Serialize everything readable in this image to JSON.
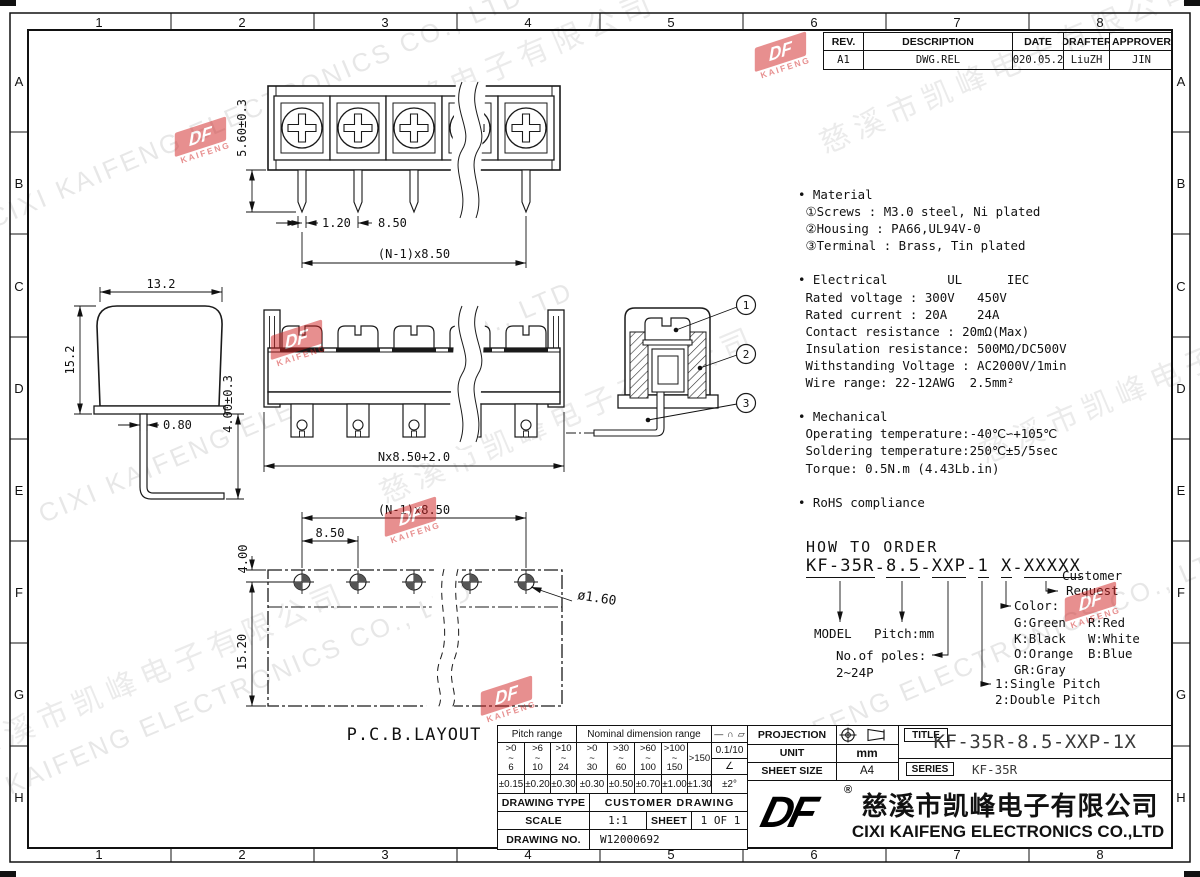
{
  "grid": {
    "cols": [
      "1",
      "2",
      "3",
      "4",
      "5",
      "6",
      "7",
      "8"
    ],
    "rows": [
      "A",
      "B",
      "C",
      "D",
      "E",
      "F",
      "G",
      "H"
    ]
  },
  "rev_table": {
    "headers": [
      "REV.",
      "DESCRIPTION",
      "DATE",
      "DRAFTER",
      "APPROVER"
    ],
    "row": [
      "A1",
      "DWG.REL",
      "2020.05.21",
      "LiuZH",
      "JIN"
    ]
  },
  "specs": {
    "lines": [
      "• Material",
      " ①Screws : M3.0 steel, Ni plated",
      " ②Housing : PA66,UL94V-0",
      " ③Terminal : Brass, Tin plated",
      "",
      "• Electrical        UL      IEC",
      " Rated voltage : 300V   450V",
      " Rated current : 20A    24A",
      " Contact resistance : 20mΩ(Max)",
      " Insulation resistance: 500MΩ/DC500V",
      " Withstanding Voltage : AC2000V/1min",
      " Wire range: 22-12AWG  2.5mm²",
      "",
      "• Mechanical",
      " Operating temperature:-40℃∽+105℃",
      " Soldering temperature:250℃±5/5sec",
      " Torque: 0.5N.m (4.43Lb.in)",
      "",
      "• RoHS compliance"
    ]
  },
  "how_to_order": {
    "title": "HOW TO ORDER",
    "joiner": "-",
    "tokens": [
      "KF-35R",
      "8.5",
      "XXP",
      "1",
      "X",
      "XXXXX"
    ],
    "model": "MODEL",
    "pitch": "Pitch:mm",
    "poles1": "No.of poles:",
    "poles2": "2~24P",
    "single": "1:Single Pitch",
    "double": "2:Double Pitch",
    "color_label": "Color:",
    "colors": [
      [
        "G:Green",
        "R:Red"
      ],
      [
        "K:Black",
        "W:White"
      ],
      [
        "O:Orange",
        "B:Blue"
      ],
      [
        "GR:Gray",
        ""
      ]
    ],
    "customer1": "Customer",
    "customer2": "Request"
  },
  "views": {
    "top": {
      "height": "5.60±0.3",
      "pin_w": "1.20",
      "pitch": "8.50",
      "span": "(N-1)x8.50"
    },
    "side": {
      "width": "13.2",
      "height": "15.2",
      "pin": "0.80",
      "foot": "4.00±0.3"
    },
    "front": {
      "span": "Nx8.50+2.0"
    },
    "section": {
      "c1": "1",
      "c2": "2",
      "c3": "3"
    },
    "pcb": {
      "span": "(N-1)x8.50",
      "pitch": "8.50",
      "offset": "4.00",
      "height": "15.20",
      "hole": "ø1.60",
      "label": "P.C.B.LAYOUT"
    }
  },
  "tol_table": {
    "pitch_header": "Pitch range",
    "nominal_header": "Nominal dimension range",
    "symbols": [
      "—",
      "∩",
      "▱"
    ],
    "tilde": "~",
    "range_top": [
      ">0",
      ">6",
      ">10",
      ">0",
      ">30",
      ">60",
      ">100"
    ],
    "range_bot": [
      "6",
      "10",
      "24",
      "30",
      "60",
      "100",
      "150"
    ],
    "range_last": ">150",
    "flatness": "0.1/10",
    "angle": "∠",
    "tols": [
      "±0.15",
      "±0.20",
      "±0.30",
      "±0.30",
      "±0.50",
      "±0.70",
      "±1.00",
      "±1.30",
      "±2°"
    ],
    "drawing_type_label": "DRAWING TYPE",
    "drawing_type": "CUSTOMER DRAWING",
    "scale_label": "SCALE",
    "scale": "1:1",
    "sheet_label": "SHEET",
    "sheet": "1 OF 1",
    "drawing_no_label": "DRAWING NO.",
    "drawing_no": "W12000692"
  },
  "title_block": {
    "projection": "PROJECTION",
    "unit_label": "UNIT",
    "unit": "mm",
    "sheet_size_label": "SHEET SIZE",
    "sheet_size": "A4",
    "title_label": "TITLE",
    "title": "KF-35R-8.5-XXP-1X",
    "series_label": "SERIES",
    "series": "KF-35R",
    "reg": "®",
    "company_cn": "慈溪市凯峰电子有限公司",
    "company_en": "CIXI KAIFENG ELECTRONICS CO.,LTD"
  },
  "watermarks": {
    "en": "CIXI KAIFENG ELECTRONICS CO., LTD",
    "cn": "慈溪市凯峰电子有限公司",
    "logo_main": "DF",
    "logo_sub": "KAIFENG"
  },
  "colors": {
    "line": "#1a1a1a",
    "logo_red": "#d02222",
    "wm_gray": "#8c8c8c"
  }
}
